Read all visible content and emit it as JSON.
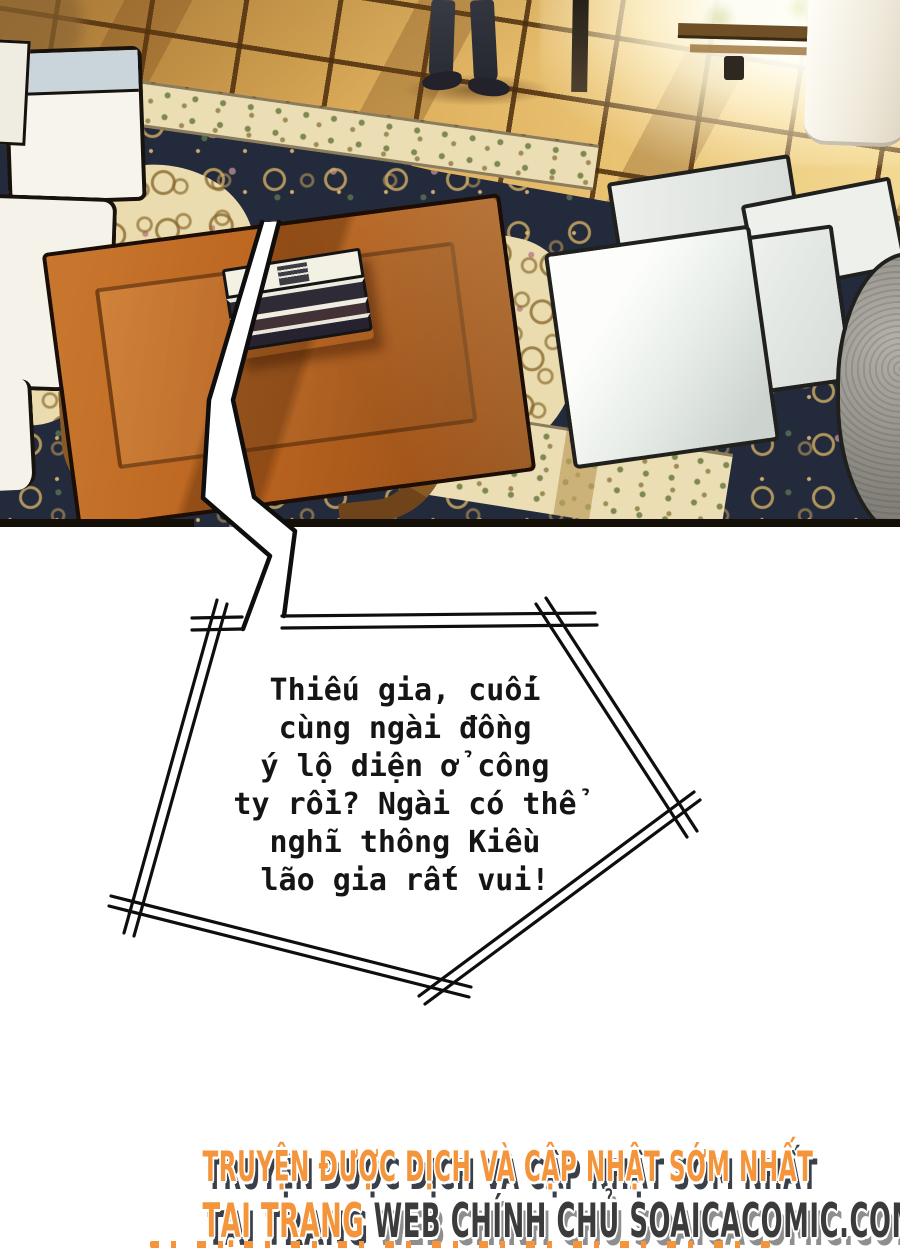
{
  "bubble": {
    "lines": [
      "Thiếu gia, cuối",
      "cùng ngài đồng",
      "ý lộ diện ở công",
      "ty rồi? Ngài có thể",
      "nghĩ thông Kiều",
      "lão gia rất vui!"
    ]
  },
  "footer": {
    "line1": "TRUYỆN ĐƯỢC DỊCH VÀ CẬP NHẬT SỚM NHẤT",
    "line2_orange": "TẠI TRANG ",
    "line2_dark": "WEB CHÍNH CHỦ SOAICACOMIC.COM"
  },
  "colors": {
    "footer_orange": "#F4953B",
    "footer_dark": "#3B3B3B",
    "footer_shadow": "#39404A",
    "wood_floor": "#D9A855",
    "carpet_navy": "#232A3C",
    "carpet_cream": "#EBDDB4",
    "table_wood": "#BB641F",
    "page_background": "#FFFFFF"
  }
}
